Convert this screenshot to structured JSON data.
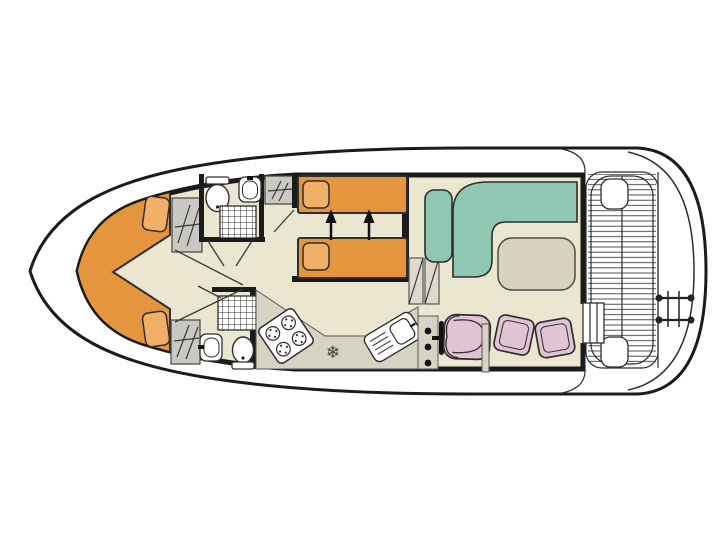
{
  "colors": {
    "white": "#FFFFFF",
    "wall": "#1B1B1B",
    "floor": "#EAE6CF",
    "counter": "#D7D3C2",
    "wardrobe": "#C9C8C1",
    "bed": "#E6953F",
    "pillow": "#F1AF67",
    "sofa": "#90C7B3",
    "table": "#D6D2BE",
    "chair": "#E0C4D3",
    "step": "#DDDACC",
    "accent_dark": "#111111"
  },
  "glyphs": {
    "fridge_snowflake": "❄"
  },
  "plan": {
    "type": "boat-deck-floorplan",
    "rooms": [
      {
        "name": "bow-cabin",
        "furniture": [
          "v-berth-double-bed",
          "pillow",
          "pillow",
          "wardrobe",
          "wardrobe"
        ]
      },
      {
        "name": "bathroom-forward",
        "furniture": [
          "toilet",
          "washbasin",
          "shower"
        ]
      },
      {
        "name": "bathroom-aft",
        "furniture": [
          "toilet",
          "washbasin",
          "shower"
        ]
      },
      {
        "name": "twin-cabin",
        "furniture": [
          "single-bed",
          "single-bed",
          "bed-slide-arrows"
        ]
      },
      {
        "name": "saloon",
        "furniture": [
          "l-shaped-sofa",
          "bench-seat",
          "table"
        ]
      },
      {
        "name": "galley",
        "furniture": [
          "hob-4-burners",
          "fridge-freezer",
          "sink-with-drainer"
        ]
      },
      {
        "name": "helm",
        "furniture": [
          "instrument-console",
          "steering-wheel",
          "helm-seat",
          "seat-cushion",
          "seat-cushion"
        ]
      },
      {
        "name": "stern-deck",
        "furniture": [
          "planked-deck",
          "corner-seat",
          "corner-seat",
          "boarding-steps",
          "swim-ladder"
        ]
      }
    ]
  }
}
